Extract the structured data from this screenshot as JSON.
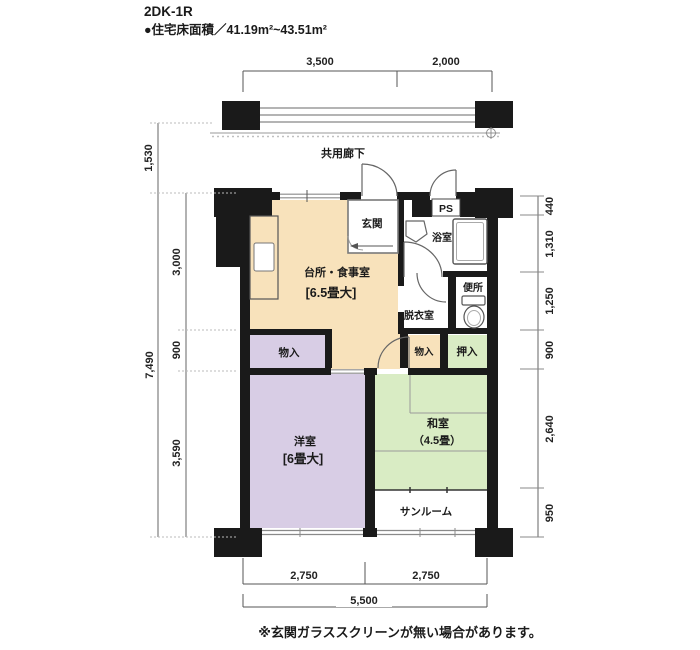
{
  "header": {
    "title": "2DK-1R",
    "subtitle": "●住宅床面積／41.19m²~43.51m²"
  },
  "plan": {
    "labels": {
      "corridor": "共用廊下",
      "genkan": "玄関",
      "ps": "PS",
      "bath": "浴室",
      "toilet": "便所",
      "dressing": "脱衣室",
      "dk_name": "台所・食事室",
      "dk_size": "[6.5畳大]",
      "storage_left": "物入",
      "storage_mid": "物入",
      "oshiire": "押入",
      "western_name": "洋室",
      "western_size": "[6畳大]",
      "japanese_name": "和室",
      "japanese_size": "（4.5畳）",
      "sunroom": "サンルーム"
    },
    "colors": {
      "wall": "#1a1a1a",
      "dk": "#f8e2bb",
      "lavender": "#d8cde5",
      "green": "#d9ecc4",
      "white": "#ffffff"
    }
  },
  "dimensions": {
    "top": {
      "seg1": "3,500",
      "seg2": "2,000"
    },
    "left": {
      "balcony": "1,530",
      "total": "7,490",
      "upper": "3,000",
      "middle": "900",
      "lower": "3,590"
    },
    "right": {
      "r1": "440",
      "r2": "1,310",
      "r3": "1,250",
      "r4": "900",
      "r5": "2,640",
      "r6": "950"
    },
    "bottom": {
      "seg1": "2,750",
      "seg2": "2,750",
      "total": "5,500"
    }
  },
  "footnote": "※玄関ガラススクリーンが無い場合があります。"
}
